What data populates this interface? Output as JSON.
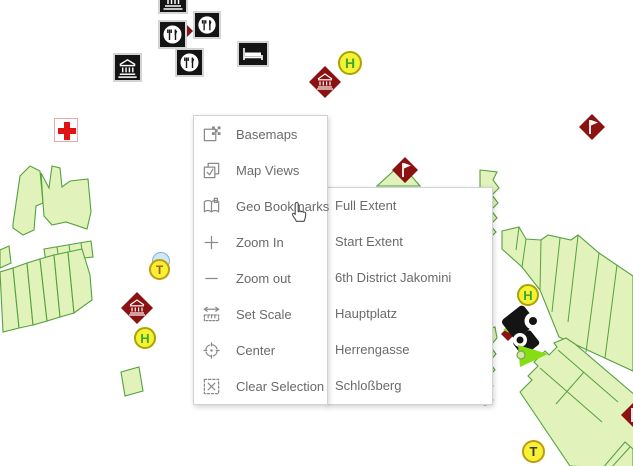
{
  "context_menu": {
    "items": [
      {
        "label": "Basemaps",
        "icon": "basemaps-icon"
      },
      {
        "label": "Map Views",
        "icon": "map-views-icon"
      },
      {
        "label": "Geo Bookmarks",
        "icon": "geo-bookmarks-icon"
      },
      {
        "label": "Zoom In",
        "icon": "zoom-in-icon"
      },
      {
        "label": "Zoom out",
        "icon": "zoom-out-icon"
      },
      {
        "label": "Set Scale",
        "icon": "set-scale-icon"
      },
      {
        "label": "Center",
        "icon": "center-icon"
      },
      {
        "label": "Clear Selection",
        "icon": "clear-selection-icon"
      }
    ]
  },
  "bookmarks_submenu": {
    "items": [
      {
        "label": "Full Extent"
      },
      {
        "label": "Start Extent"
      },
      {
        "label": "6th District Jakomini"
      },
      {
        "label": "Hauptplatz"
      },
      {
        "label": "Herrengasse"
      },
      {
        "label": "Schloßberg"
      }
    ]
  },
  "map": {
    "letters": {
      "h": "H",
      "t": "T"
    },
    "poi_icons": [
      "museum-poi-icon",
      "restaurant-poi-icon",
      "hotel-bed-poi-icon",
      "hospital-cross-poi-icon",
      "museum-diamond-poi-icon",
      "flag-diamond-poi-icon",
      "bus-stop-h-marker",
      "tram-stop-t-marker",
      "vehicle-marker-icon",
      "direction-arrow-icon"
    ]
  },
  "colors": {
    "parcel_fill": "#e1f2bb",
    "parcel_stroke": "#55a13f",
    "poi_red": "#8c1111",
    "poi_black": "#141414",
    "stop_yellow": "#f6f233",
    "stop_border_h": "#a8a400",
    "stop_border_t": "#c09a10",
    "h_green": "#3aa835",
    "t_orange": "#a55c14",
    "t_dark": "#3a3a3a",
    "arrow_green": "#86dd12",
    "cross_red": "#e01212",
    "blue_fill": "#cfe8f7",
    "blue_border": "#86aed0",
    "menu_text": "#6a6a6a",
    "icon_gray": "#8a8a8a"
  }
}
